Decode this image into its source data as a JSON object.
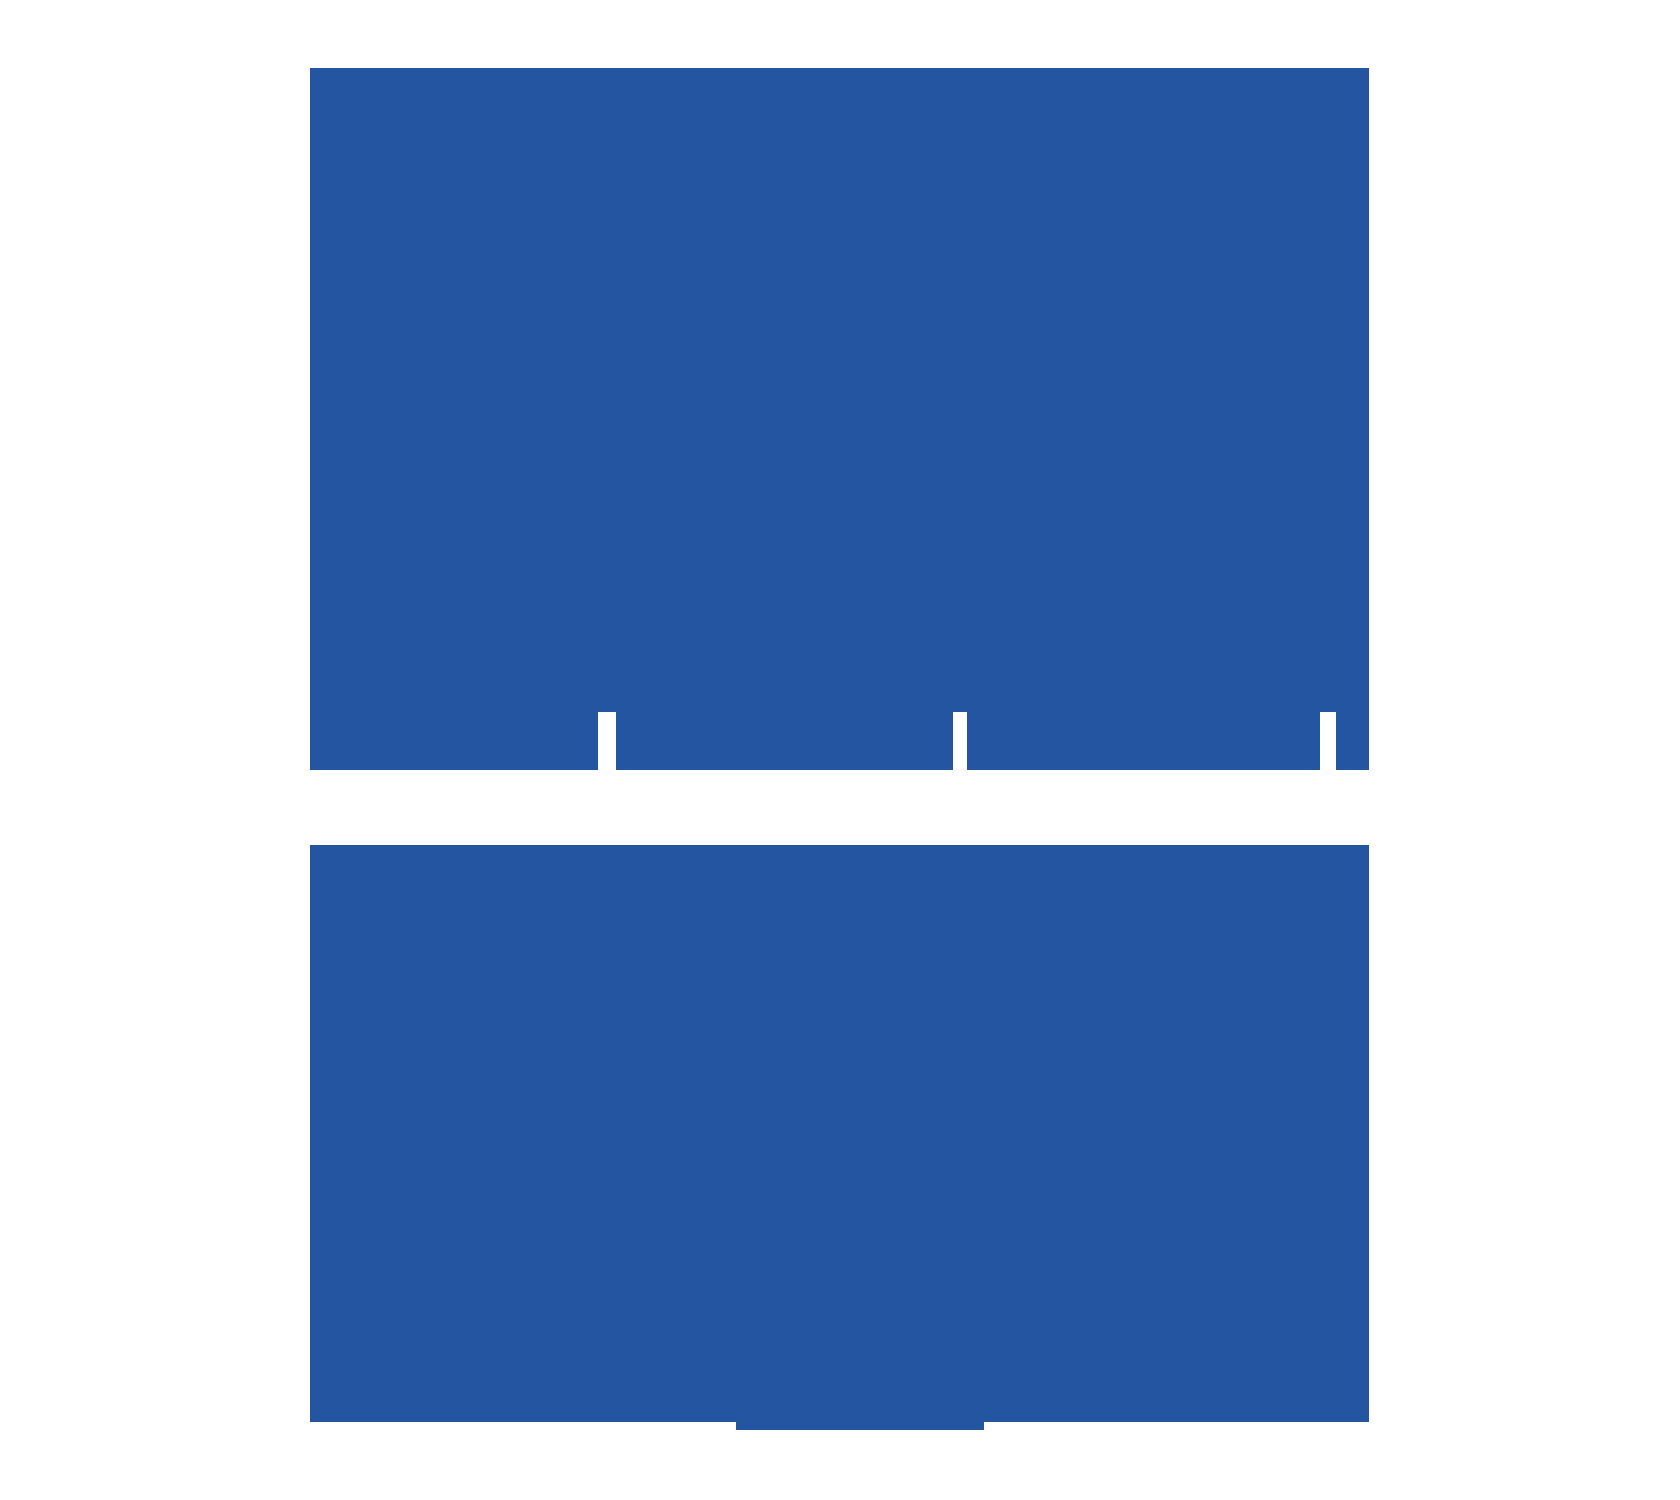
{
  "canvas": {
    "width": 1680,
    "height": 1500,
    "background_color": "#ffffff"
  },
  "palette": {
    "primary_blue": "#2355a1",
    "background_white": "#ffffff"
  },
  "figure": {
    "description_name": "two-blue-blocks-graphic",
    "shapes": [
      {
        "name": "top-block-body",
        "x": 310,
        "y": 68,
        "w": 1059,
        "h": 644,
        "fill": "primary_blue"
      },
      {
        "name": "top-block-bottom-segment-1",
        "x": 310,
        "y": 712,
        "w": 288,
        "h": 58,
        "fill": "primary_blue"
      },
      {
        "name": "top-block-bottom-segment-2",
        "x": 616,
        "y": 712,
        "w": 337,
        "h": 58,
        "fill": "primary_blue"
      },
      {
        "name": "top-block-bottom-segment-3",
        "x": 967,
        "y": 712,
        "w": 353,
        "h": 58,
        "fill": "primary_blue"
      },
      {
        "name": "top-block-bottom-segment-4",
        "x": 1336,
        "y": 712,
        "w": 33,
        "h": 58,
        "fill": "primary_blue"
      },
      {
        "name": "bottom-block-body",
        "x": 310,
        "y": 845,
        "w": 1059,
        "h": 577,
        "fill": "primary_blue"
      },
      {
        "name": "bottom-block-tab",
        "x": 736,
        "y": 1422,
        "w": 248,
        "h": 8,
        "fill": "primary_blue"
      }
    ],
    "white_slits": [
      {
        "name": "top-block-slit-1",
        "x": 598,
        "y": 712,
        "w": 18,
        "h": 58
      },
      {
        "name": "top-block-slit-2",
        "x": 953,
        "y": 712,
        "w": 14,
        "h": 58
      },
      {
        "name": "top-block-slit-3",
        "x": 1320,
        "y": 712,
        "w": 16,
        "h": 58
      }
    ]
  }
}
